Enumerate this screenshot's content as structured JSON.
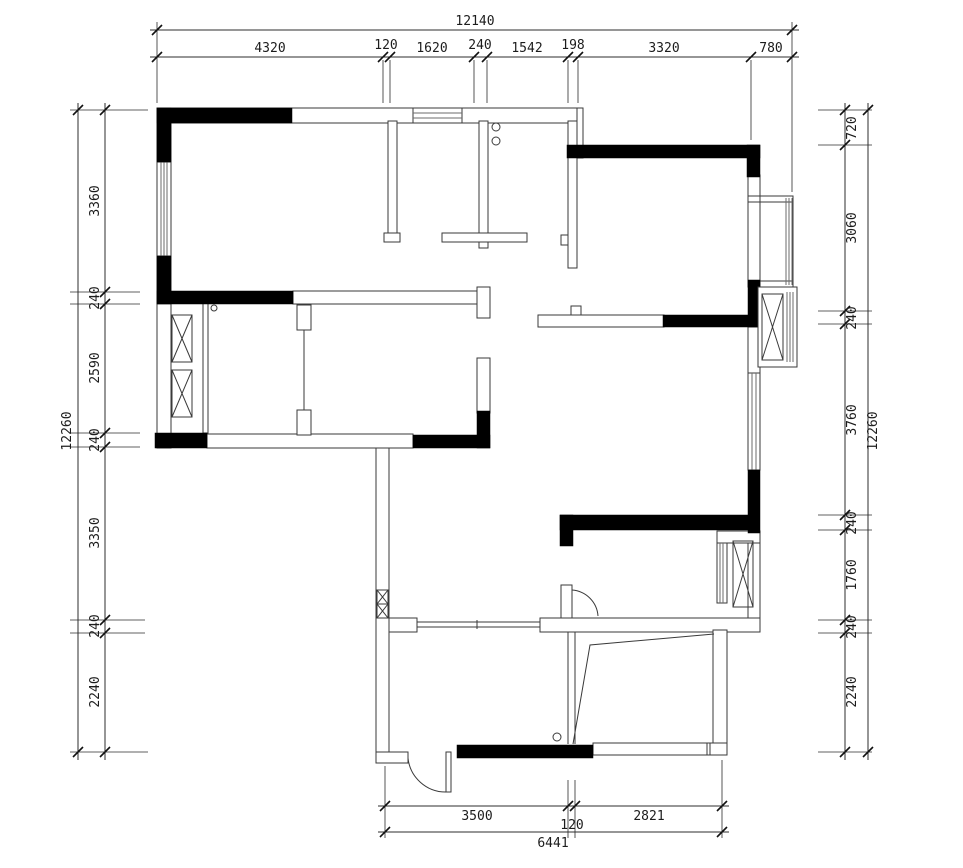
{
  "dims": {
    "top": {
      "total": "12140",
      "segments": [
        "4320",
        "120",
        "1620",
        "240",
        "1542",
        "198",
        "3320",
        "780"
      ]
    },
    "left": {
      "total": "12260",
      "segments": [
        "3360",
        "240",
        "2590",
        "240",
        "3350",
        "240",
        "2240"
      ]
    },
    "right": {
      "total": "12260",
      "segments": [
        "720",
        "3060",
        "240",
        "3760",
        "240",
        "1760",
        "240",
        "2240"
      ]
    },
    "bottom": {
      "total": "6441",
      "segments": [
        "3500",
        "120",
        "2821"
      ]
    }
  },
  "colors": {
    "background": "#ffffff",
    "wall_fill": "#000000",
    "line": "#3a3a3a",
    "dim_line": "#2c2c2c",
    "text": "#1c1c1c"
  }
}
